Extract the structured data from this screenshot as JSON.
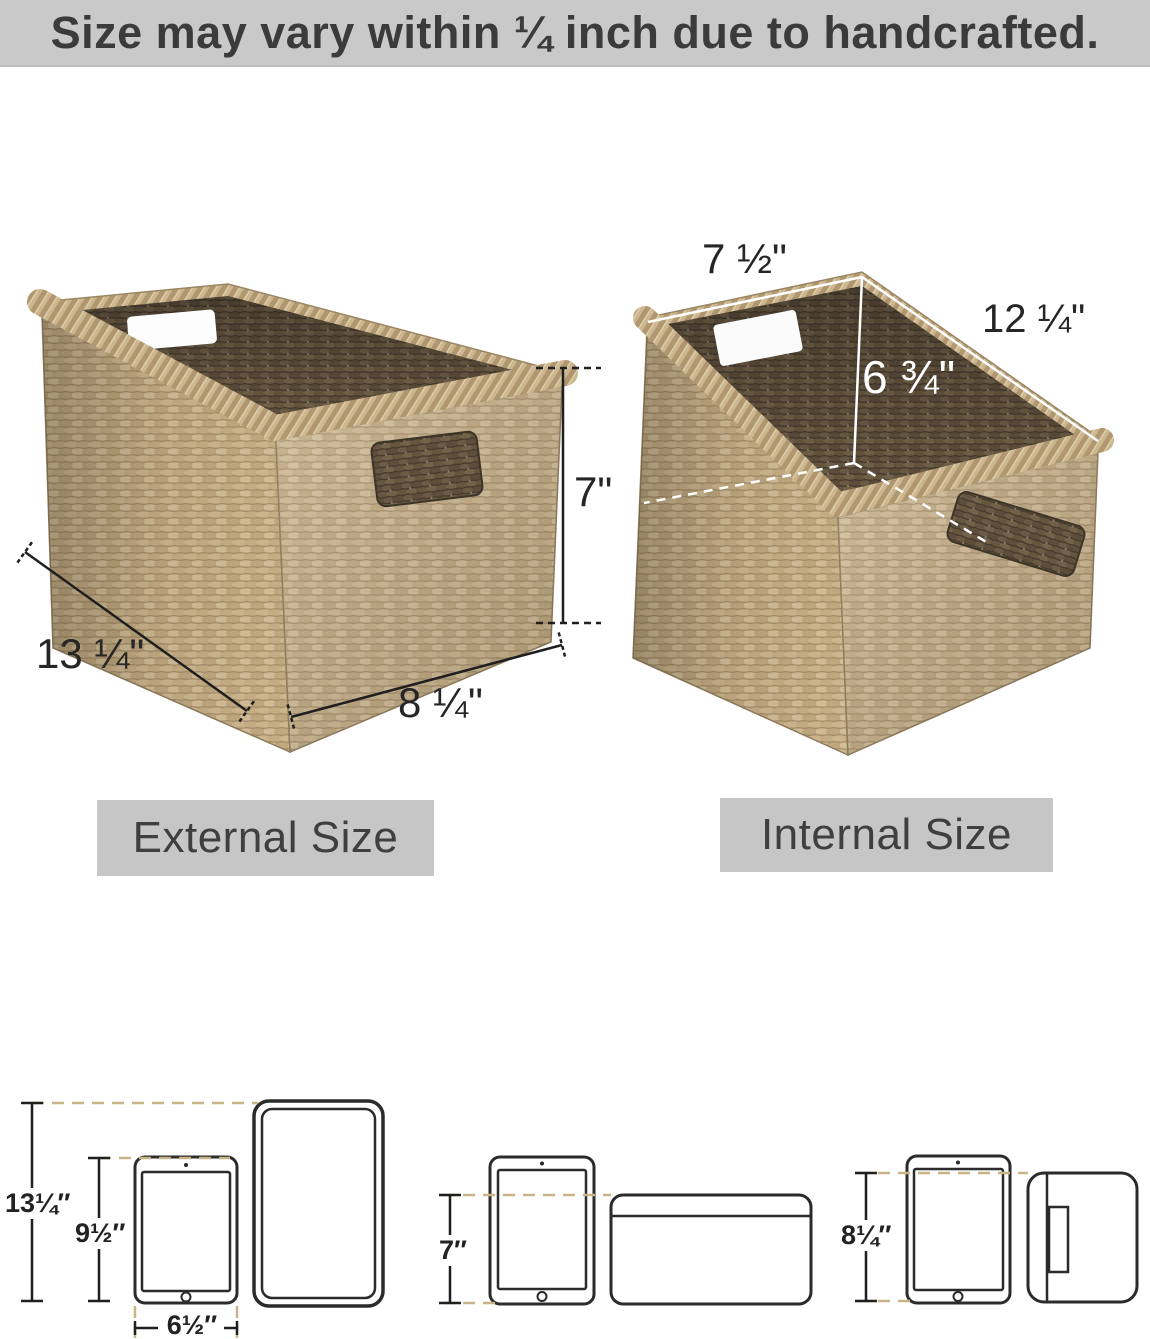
{
  "banner": {
    "text": "Size may vary within ¼ inch due to handcrafted."
  },
  "external": {
    "label": "External Size",
    "height": "7\"",
    "length": "13 ¼\"",
    "width": "8 ¼\""
  },
  "internal": {
    "label": "Internal Size",
    "width": "7 ½\"",
    "length": "12 ¼\"",
    "height": "6 ¾\""
  },
  "size_comparison": {
    "basket_height": "13¼″",
    "tablet_height": "9½″",
    "tablet_width": "6½″",
    "front_height": "7″",
    "side_height": "8¼″"
  },
  "colors": {
    "banner_bg": "#c9c9c9",
    "label_bg": "#c6c6c6",
    "text_dark": "#3b3b3b",
    "dimension_line": "#1f1f1f",
    "tan_dash": "#c9b488",
    "white_line": "#ffffff",
    "weave_light": "#c3ac85",
    "weave_dark": "#5e5040"
  }
}
